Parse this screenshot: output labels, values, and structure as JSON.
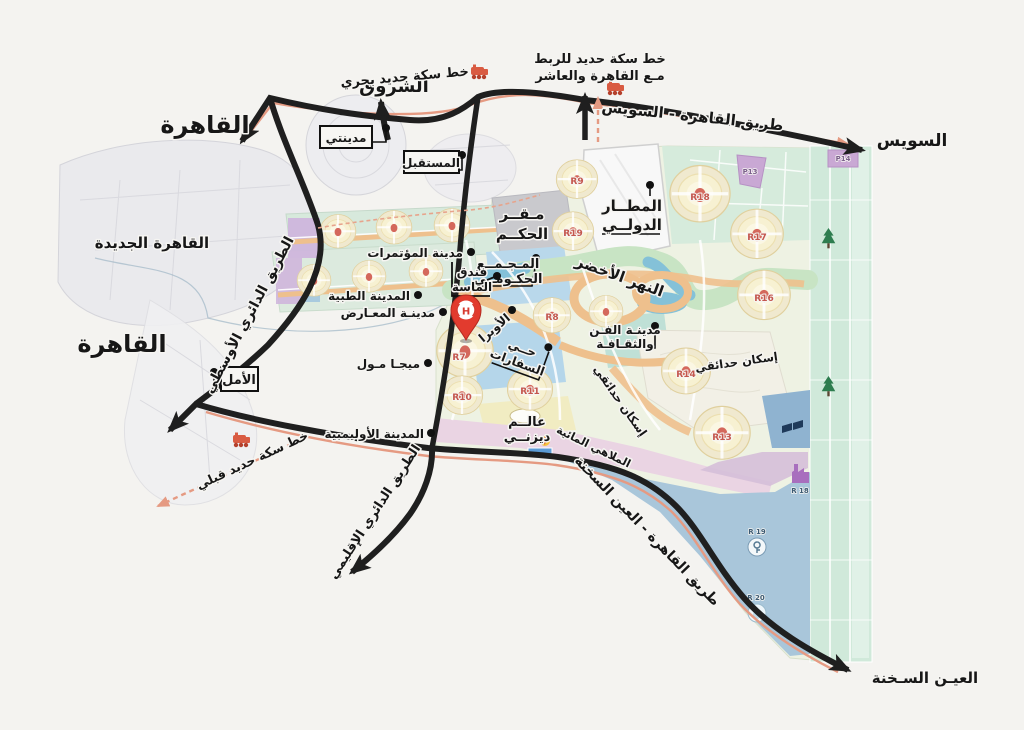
{
  "labels": {
    "cairo_top": "القاهرة",
    "shorouk": "الشروق",
    "rail_north": "خط سكة حديد بحري",
    "madinaty": "مدينتي",
    "mostakbal": "المستقبل",
    "rail_link_1": "خط سكة حديد للربط",
    "rail_link_2": "مـع القاهرة والعاشر",
    "cairo_suez": "طريق القاهرة - السويس",
    "suez": "السويس",
    "new_cairo": "القاهرة الجديدة",
    "cairo_mid": "القاهرة",
    "middle_ring": "الطريق الدائري الأوسطي",
    "amal": "الأمل",
    "rail_south": "خط سكة حديد قبلي",
    "regional_ring": "الطريق الدائري الإقليمي",
    "sokhna_road": "طريق القاهرة - العين السخنة",
    "ain_sokhna": "العيـن السـخنة",
    "airport_1": "المطــار",
    "airport_2": "الدولــي",
    "gov_hq_1": "مـقــر",
    "gov_hq_2": "الحكــم",
    "gov_complex_1": "المـجـمــع",
    "gov_complex_2": "الحكـومــي",
    "conferences": "مدينة المؤتمرات",
    "massa_1": "فندق",
    "massa_2": "الماسة",
    "green_river": "النهر الأخضر",
    "opera": "الأوبرا",
    "medical": "المدينة الطبية",
    "expo": "مدينـة المعـارض",
    "mega_mall": "ميجـا مـول",
    "embassies_1": "حــي",
    "embassies_2": "السفارات",
    "arts_1": "مدينـة الفـن",
    "arts_2": "والثقـافـة",
    "garden_a": "إسكان حدائقي",
    "garden_b": "إسكان حدائقي",
    "olympic": "المدينة الأوليمبية",
    "disney_1": "عالــم",
    "disney_2": "ديزنــي",
    "water_parks": "الملاهي المائية"
  },
  "districts": {
    "r7": "R7",
    "r8": "R8",
    "r9": "R9",
    "r19": "R19",
    "r10": "R10",
    "r11": "R11",
    "r13": "R13",
    "r14": "R14",
    "r16": "R16",
    "r17": "R17",
    "r18": "R18",
    "p13": "P13",
    "p14": "P14",
    "zone_r18": "R 18",
    "zone_r19": "R 19",
    "zone_r20": "R 20"
  },
  "pin": {
    "letter": "H"
  },
  "colors": {
    "road_black": "#1f1f1f",
    "rail_salmon": "#e59a82",
    "pin_red": "#e23b2e",
    "district_yellow": "#f0e9cf",
    "district_center_red": "#d4685c",
    "green_river": "#c8e4c4",
    "water_blue": "#84c1d8",
    "zone_blue": "#b9d8eb",
    "zone_purple": "#cfb6dc",
    "agri_green": "#d0e9da",
    "south_blue": "#a9c6da",
    "disney_pink": "#ead4e3",
    "gov_gray": "#c9c9cd"
  }
}
